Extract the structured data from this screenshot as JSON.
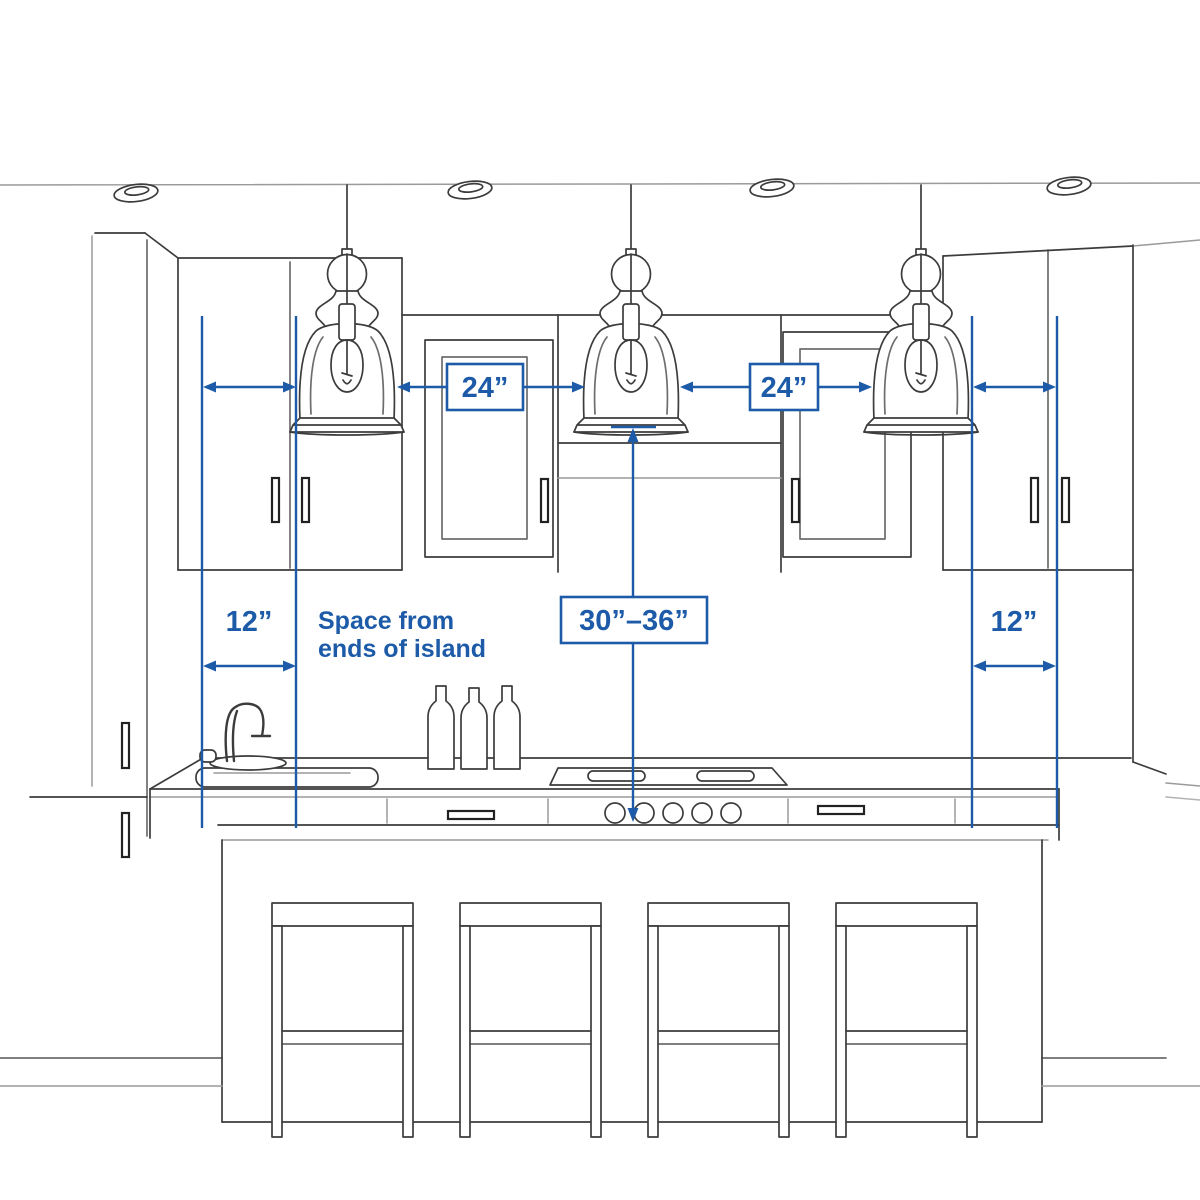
{
  "annotations": {
    "pendant_spacing_left": "24”",
    "pendant_spacing_right": "24”",
    "end_space_left": "12”",
    "end_space_right": "12”",
    "height_above_island": "30”–36”",
    "note_line1": "Space from",
    "note_line2": "ends of island"
  },
  "colors": {
    "annotation_blue": "#1d5ba8",
    "sketch_dark": "#3c3c3c",
    "sketch_light": "#9a9a9a"
  }
}
